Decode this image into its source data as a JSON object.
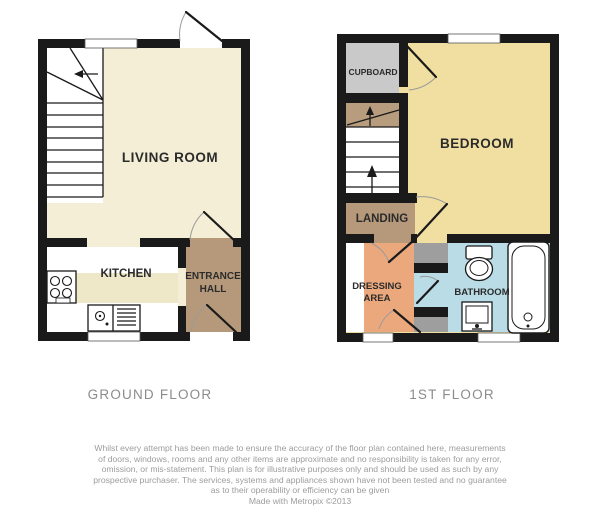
{
  "floor_plans": {
    "ground_floor": {
      "caption": "GROUND FLOOR",
      "rooms": {
        "living_room": "LIVING ROOM",
        "kitchen": "KITCHEN",
        "entrance_hall_line1": "ENTRANCE",
        "entrance_hall_line2": "HALL"
      }
    },
    "first_floor": {
      "caption": "1ST FLOOR",
      "rooms": {
        "bedroom": "BEDROOM",
        "cupboard": "CUPBOARD",
        "landing": "LANDING",
        "dressing_line1": "DRESSING",
        "dressing_line2": "AREA",
        "bathroom": "BATHROOM"
      }
    }
  },
  "colors": {
    "wall": "#1a1a1a",
    "living_room_cream": "#f4eed6",
    "kitchen_counter": "#efe8c8",
    "hall_landing_brown": "#b5997a",
    "stair_top_brown": "#b89c7e",
    "bedroom_yellow": "#f1dfa2",
    "cupboard_gray": "#c9c9c9",
    "dressing_orange": "#eba87d",
    "bathroom_blue": "#b9dce6",
    "storage_block_gray": "#9e9e9e",
    "caption_gray": "#8c8c8c",
    "disclaimer_gray": "#9c9c9c"
  },
  "disclaimer": {
    "lines": [
      "Whilst every attempt has been made to ensure the accuracy of the floor plan contained here, measurements",
      "of doors, windows, rooms and any other items are approximate and no responsibility is taken for any error,",
      "omission, or mis-statement. This plan is for illustrative purposes only and should be used as such by any",
      "prospective purchaser. The services, systems and appliances shown have not been tested and no guarantee",
      "as to their operability or efficiency can be given"
    ],
    "credit": "Made with Metropix ©2013"
  }
}
